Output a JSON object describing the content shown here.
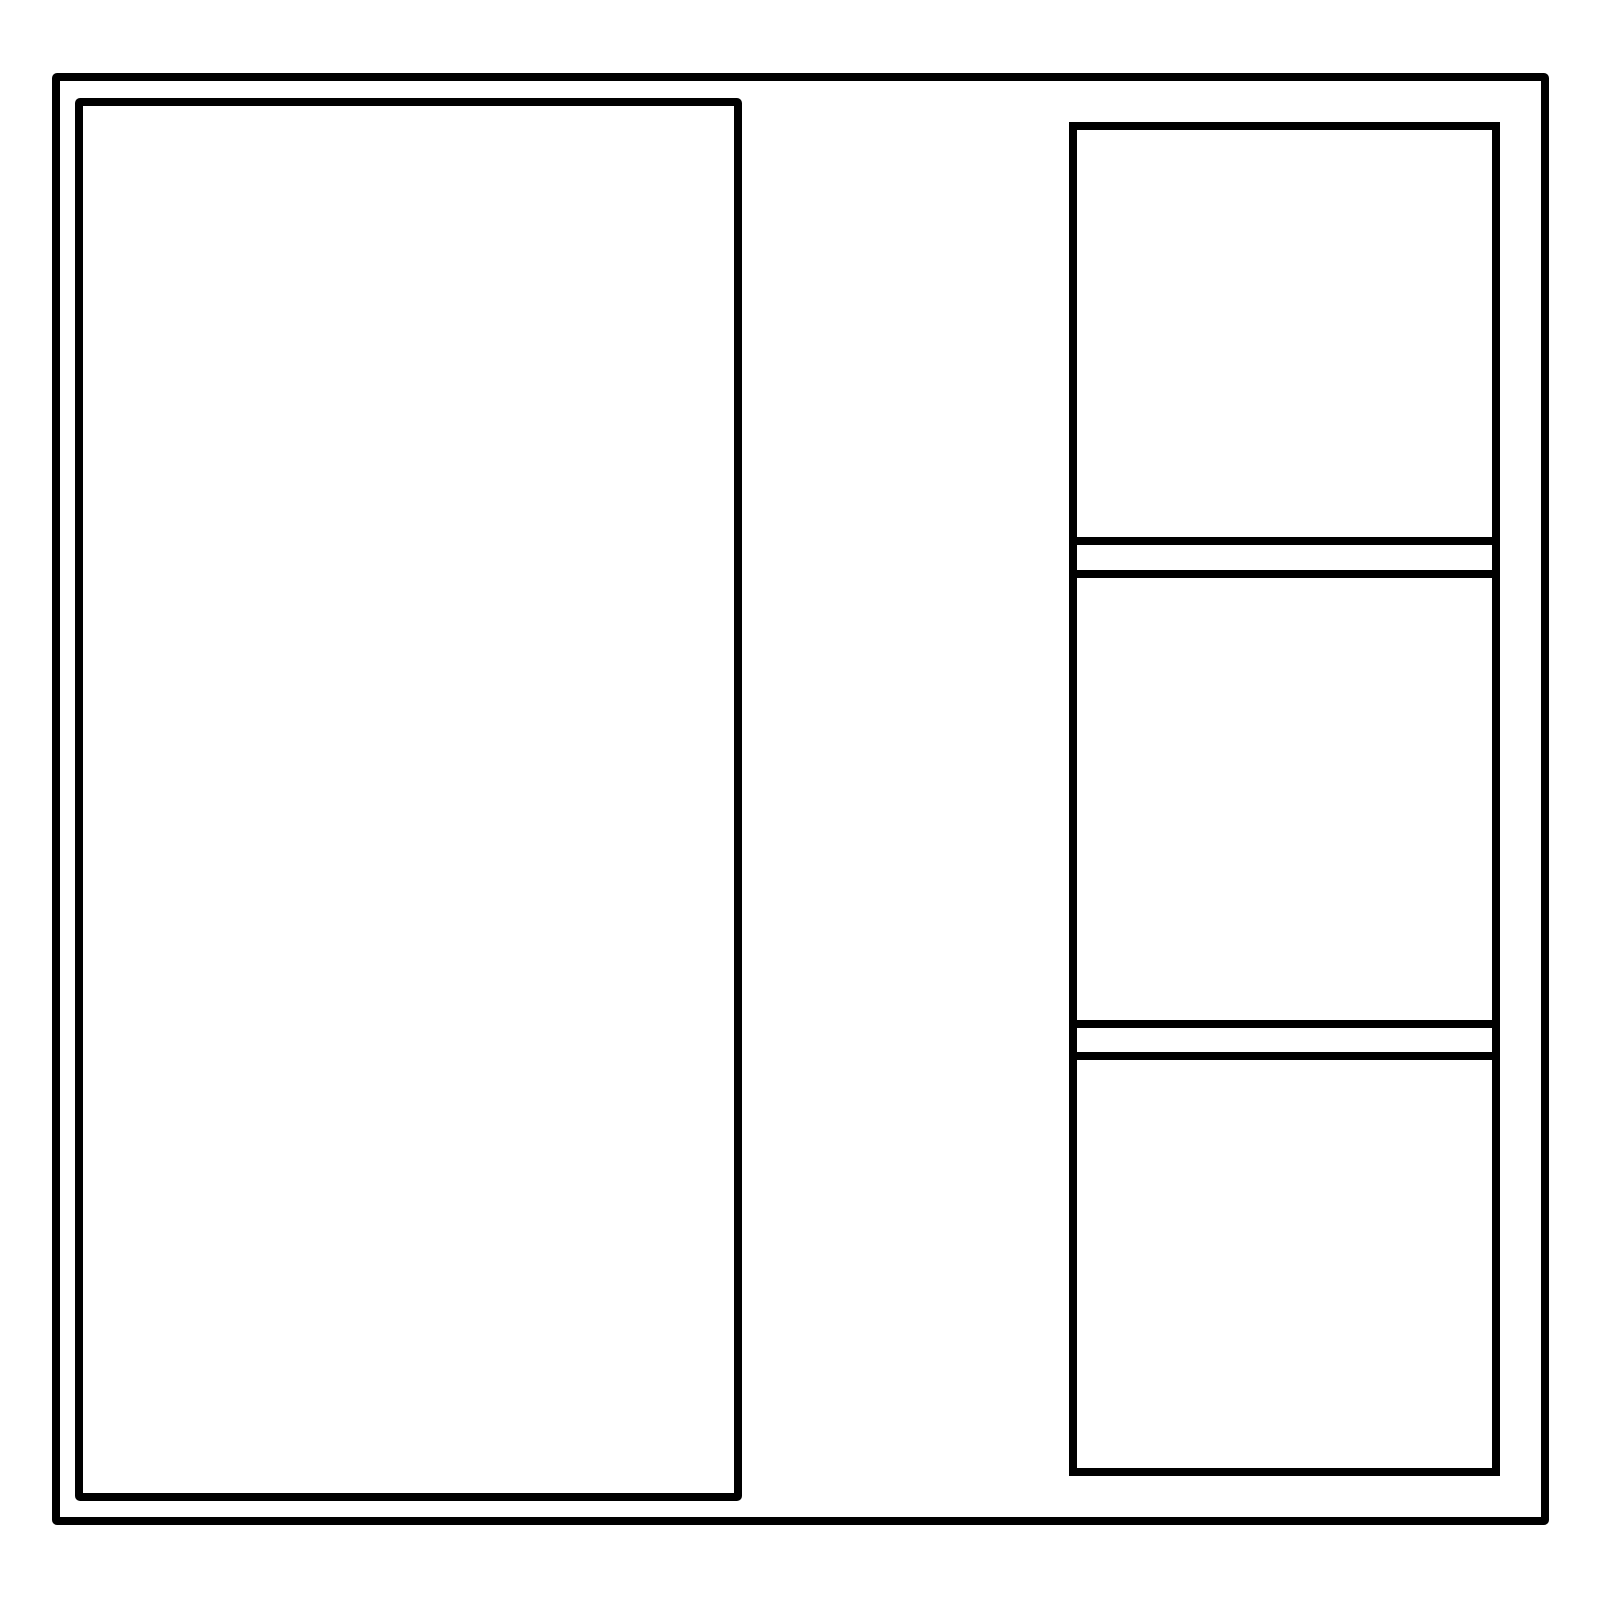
{
  "canvas": {
    "width": 1600,
    "height": 1600,
    "background": "#ffffff"
  },
  "style": {
    "stroke_color": "#000000",
    "stroke_width": 8,
    "shape_fill": "#ffffff",
    "corner_radius": 5
  },
  "shapes": {
    "outer_frame": {
      "x": 52,
      "y": 73,
      "width": 1497,
      "height": 1452
    },
    "left_panel": {
      "x": 75,
      "y": 98,
      "width": 667,
      "height": 1403
    },
    "right_column": {
      "x": 1069,
      "y": 122,
      "width": 431,
      "height": 1354,
      "rows": [
        {
          "kind": "box",
          "name": "right-top-box",
          "height": 423
        },
        {
          "kind": "gap",
          "name": "right-gap-1",
          "height": 25
        },
        {
          "kind": "box",
          "name": "right-middle-box",
          "height": 458
        },
        {
          "kind": "gap",
          "name": "right-gap-2",
          "height": 24
        },
        {
          "kind": "box",
          "name": "right-bottom-box",
          "height": 424
        }
      ]
    }
  }
}
